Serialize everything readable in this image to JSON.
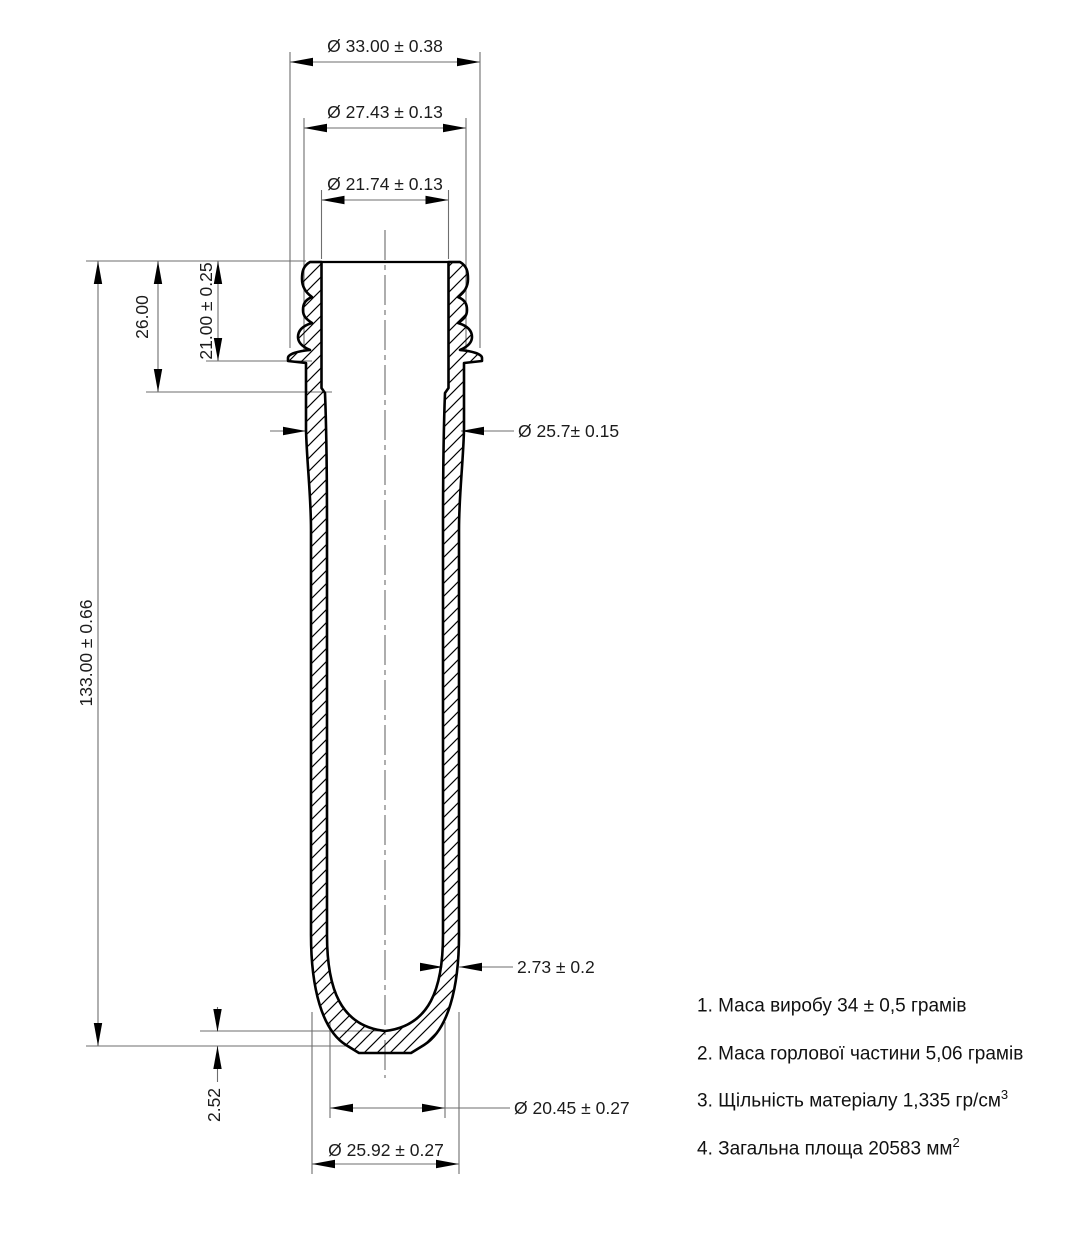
{
  "drawing": {
    "dim_labels": {
      "neck_crest_dia": "Ø 33.00 ± 0.38",
      "neck_outer_dia": "Ø 27.43 ± 0.13",
      "neck_inner_dia": "Ø 21.74 ± 0.13",
      "neck_total_height": "26.00",
      "thread_height": "21.00 ± 0.25",
      "overall_length": "133.00 ± 0.66",
      "body_outer_dia": "Ø 25.7± 0.15",
      "wall_thickness": "2.73 ± 0.2",
      "base_thickness": "2.52",
      "base_inner_dia": "Ø 20.45 ± 0.27",
      "base_outer_dia": "Ø 25.92 ± 0.27"
    },
    "notes": [
      {
        "text": "1. Маса виробу 34 ± 0,5 грамів",
        "sup": ""
      },
      {
        "text": "2. Маса горлової частини 5,06 грамів",
        "sup": ""
      },
      {
        "text": "3. Щільність матеріалу 1,335 гр/см",
        "sup": "3"
      },
      {
        "text": "4. Загальна площа 20583 мм",
        "sup": "2"
      }
    ]
  }
}
